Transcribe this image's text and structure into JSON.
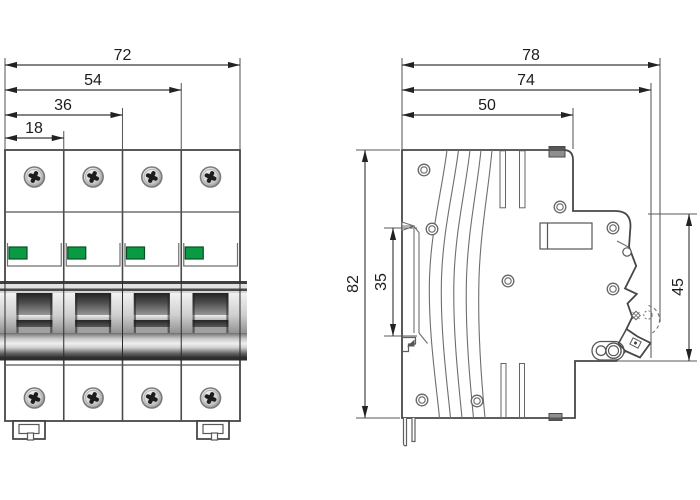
{
  "front_view": {
    "pole_count": 4,
    "indicator_color": "#0B9A44",
    "dimensions": {
      "total_width": "72",
      "three_pole_width": "54",
      "two_pole_width": "36",
      "pole_width": "18"
    }
  },
  "side_view": {
    "dimensions": {
      "total_depth": "78",
      "handle_depth": "74",
      "base_depth": "50",
      "total_height": "82",
      "din_recess_height": "35",
      "front_section_height": "45"
    }
  },
  "colors": {
    "outline": "#474747",
    "dimension_line": "#3A3A3A",
    "indicator_green": "#0B9A44",
    "background": "#FFFFFF"
  }
}
